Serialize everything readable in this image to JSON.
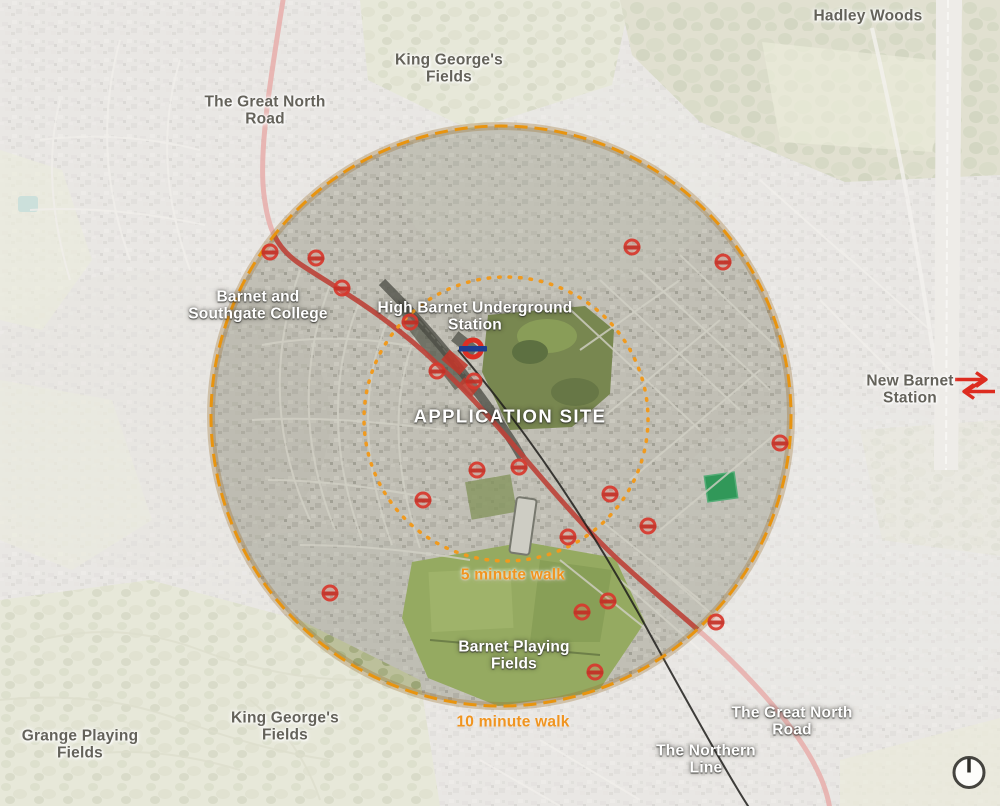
{
  "map": {
    "labels": [
      {
        "id": "label-hadley-woods",
        "lines": [
          "Hadley Woods"
        ],
        "x": 868,
        "y": 16,
        "style": "dark"
      },
      {
        "id": "label-king-georges-fields-top",
        "lines": [
          "King George's",
          "Fields"
        ],
        "x": 449,
        "y": 69,
        "style": "dark"
      },
      {
        "id": "label-great-north-road-top",
        "lines": [
          "The Great North",
          "Road"
        ],
        "x": 265,
        "y": 111,
        "style": "dark"
      },
      {
        "id": "label-barnet-southgate-college",
        "lines": [
          "Barnet and",
          "Southgate College"
        ],
        "x": 258,
        "y": 306,
        "style": "light"
      },
      {
        "id": "label-high-barnet-underground-station",
        "lines": [
          "High Barnet Underground",
          "Station"
        ],
        "x": 475,
        "y": 317,
        "style": "light"
      },
      {
        "id": "label-application-site",
        "lines": [
          "APPLICATION SITE"
        ],
        "x": 510,
        "y": 417,
        "style": "light big"
      },
      {
        "id": "label-new-barnet-station",
        "lines": [
          "New Barnet",
          "Station"
        ],
        "x": 910,
        "y": 390,
        "style": "dark"
      },
      {
        "id": "label-five-minute-walk",
        "lines": [
          "5 minute walk"
        ],
        "x": 513,
        "y": 575,
        "style": "orange"
      },
      {
        "id": "label-barnet-playing-fields",
        "lines": [
          "Barnet Playing",
          "Fields"
        ],
        "x": 514,
        "y": 656,
        "style": "light"
      },
      {
        "id": "label-ten-minute-walk",
        "lines": [
          "10 minute walk"
        ],
        "x": 513,
        "y": 722,
        "style": "orange"
      },
      {
        "id": "label-king-georges-fields-bottom",
        "lines": [
          "King George's",
          "Fields"
        ],
        "x": 285,
        "y": 727,
        "style": "dark"
      },
      {
        "id": "label-grange-playing-fields",
        "lines": [
          "Grange Playing",
          "Fields"
        ],
        "x": 80,
        "y": 745,
        "style": "dark"
      },
      {
        "id": "label-great-north-road-bottom",
        "lines": [
          "The Great North",
          "Road"
        ],
        "x": 792,
        "y": 722,
        "style": "light"
      },
      {
        "id": "label-northern-line",
        "lines": [
          "The Northern",
          "Line"
        ],
        "x": 706,
        "y": 760,
        "style": "light"
      }
    ],
    "bus_stops": [
      {
        "x": 270,
        "y": 252
      },
      {
        "x": 316,
        "y": 258
      },
      {
        "x": 342,
        "y": 288
      },
      {
        "x": 410,
        "y": 322
      },
      {
        "x": 437,
        "y": 371
      },
      {
        "x": 474,
        "y": 381
      },
      {
        "x": 423,
        "y": 500
      },
      {
        "x": 477,
        "y": 470
      },
      {
        "x": 519,
        "y": 467
      },
      {
        "x": 330,
        "y": 593
      },
      {
        "x": 568,
        "y": 537
      },
      {
        "x": 610,
        "y": 494
      },
      {
        "x": 648,
        "y": 526
      },
      {
        "x": 582,
        "y": 612
      },
      {
        "x": 608,
        "y": 601
      },
      {
        "x": 595,
        "y": 672
      },
      {
        "x": 716,
        "y": 622
      },
      {
        "x": 780,
        "y": 443
      },
      {
        "x": 632,
        "y": 247
      },
      {
        "x": 723,
        "y": 262
      }
    ],
    "icons": {
      "underground_roundel": {
        "x": 473,
        "y": 351
      },
      "national_rail": {
        "x": 975,
        "y": 388
      },
      "north_compass": {
        "x": 969,
        "y": 775
      }
    },
    "circles": {
      "outer": {
        "cx": 501,
        "cy": 416,
        "r": 290
      },
      "inner": {
        "cx": 506,
        "cy": 419,
        "r": 142
      }
    },
    "colors": {
      "walk_circle_orange": "#e8940f",
      "walk_text_orange": "#f0941f",
      "road_red": "#c64038",
      "northern_line_black": "#1f1d1b",
      "bus_stop_red": "#d8392e",
      "underground_blue": "#1d3d8f",
      "national_rail_red": "#dd2c20"
    }
  }
}
